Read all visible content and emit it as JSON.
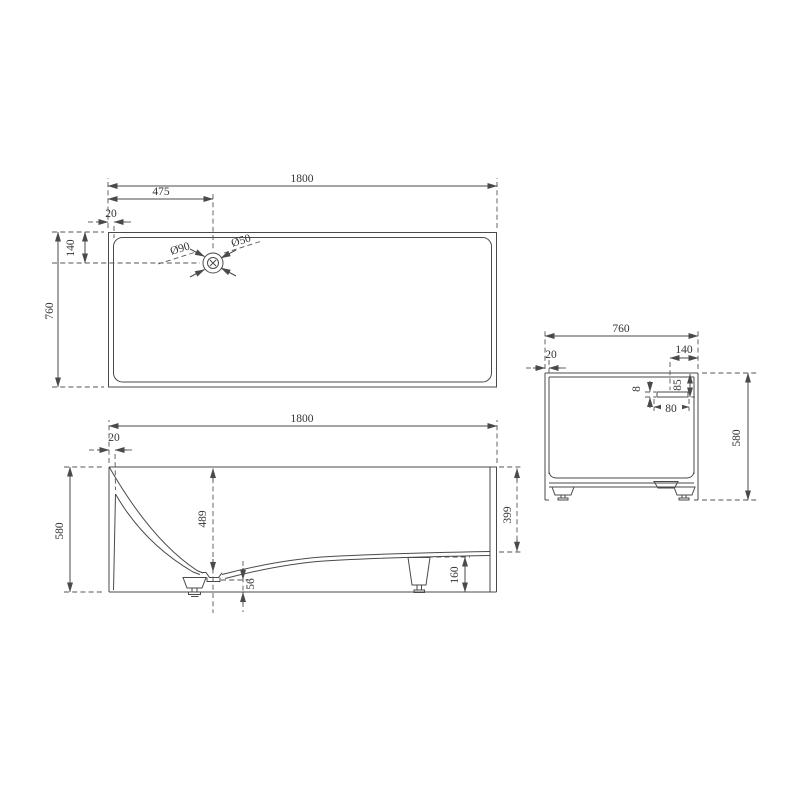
{
  "drawing": {
    "type": "bathtub-technical-drawing",
    "colors": {
      "background": "#ffffff",
      "line": "#4a4a4a",
      "text": "#333333"
    },
    "views": {
      "top": {
        "length": "1800",
        "drain_center_from_left": "475",
        "rim_thickness": "20",
        "drain_center_from_top": "140",
        "width": "760",
        "drain_outer_diameter": "Ø90",
        "drain_inner_diameter": "Ø50"
      },
      "front": {
        "length": "1800",
        "rim_thickness": "20",
        "height": "580",
        "depth_at_drain": "489",
        "drain_to_floor": "56",
        "depth_at_shallow_end": "399",
        "base_height": "160"
      },
      "side": {
        "width": "760",
        "rim_thickness": "20",
        "overflow_from_right": "140",
        "overflow_slot_height": "8",
        "overflow_from_top": "85",
        "overflow_slot_width": "80",
        "height": "580"
      }
    }
  }
}
